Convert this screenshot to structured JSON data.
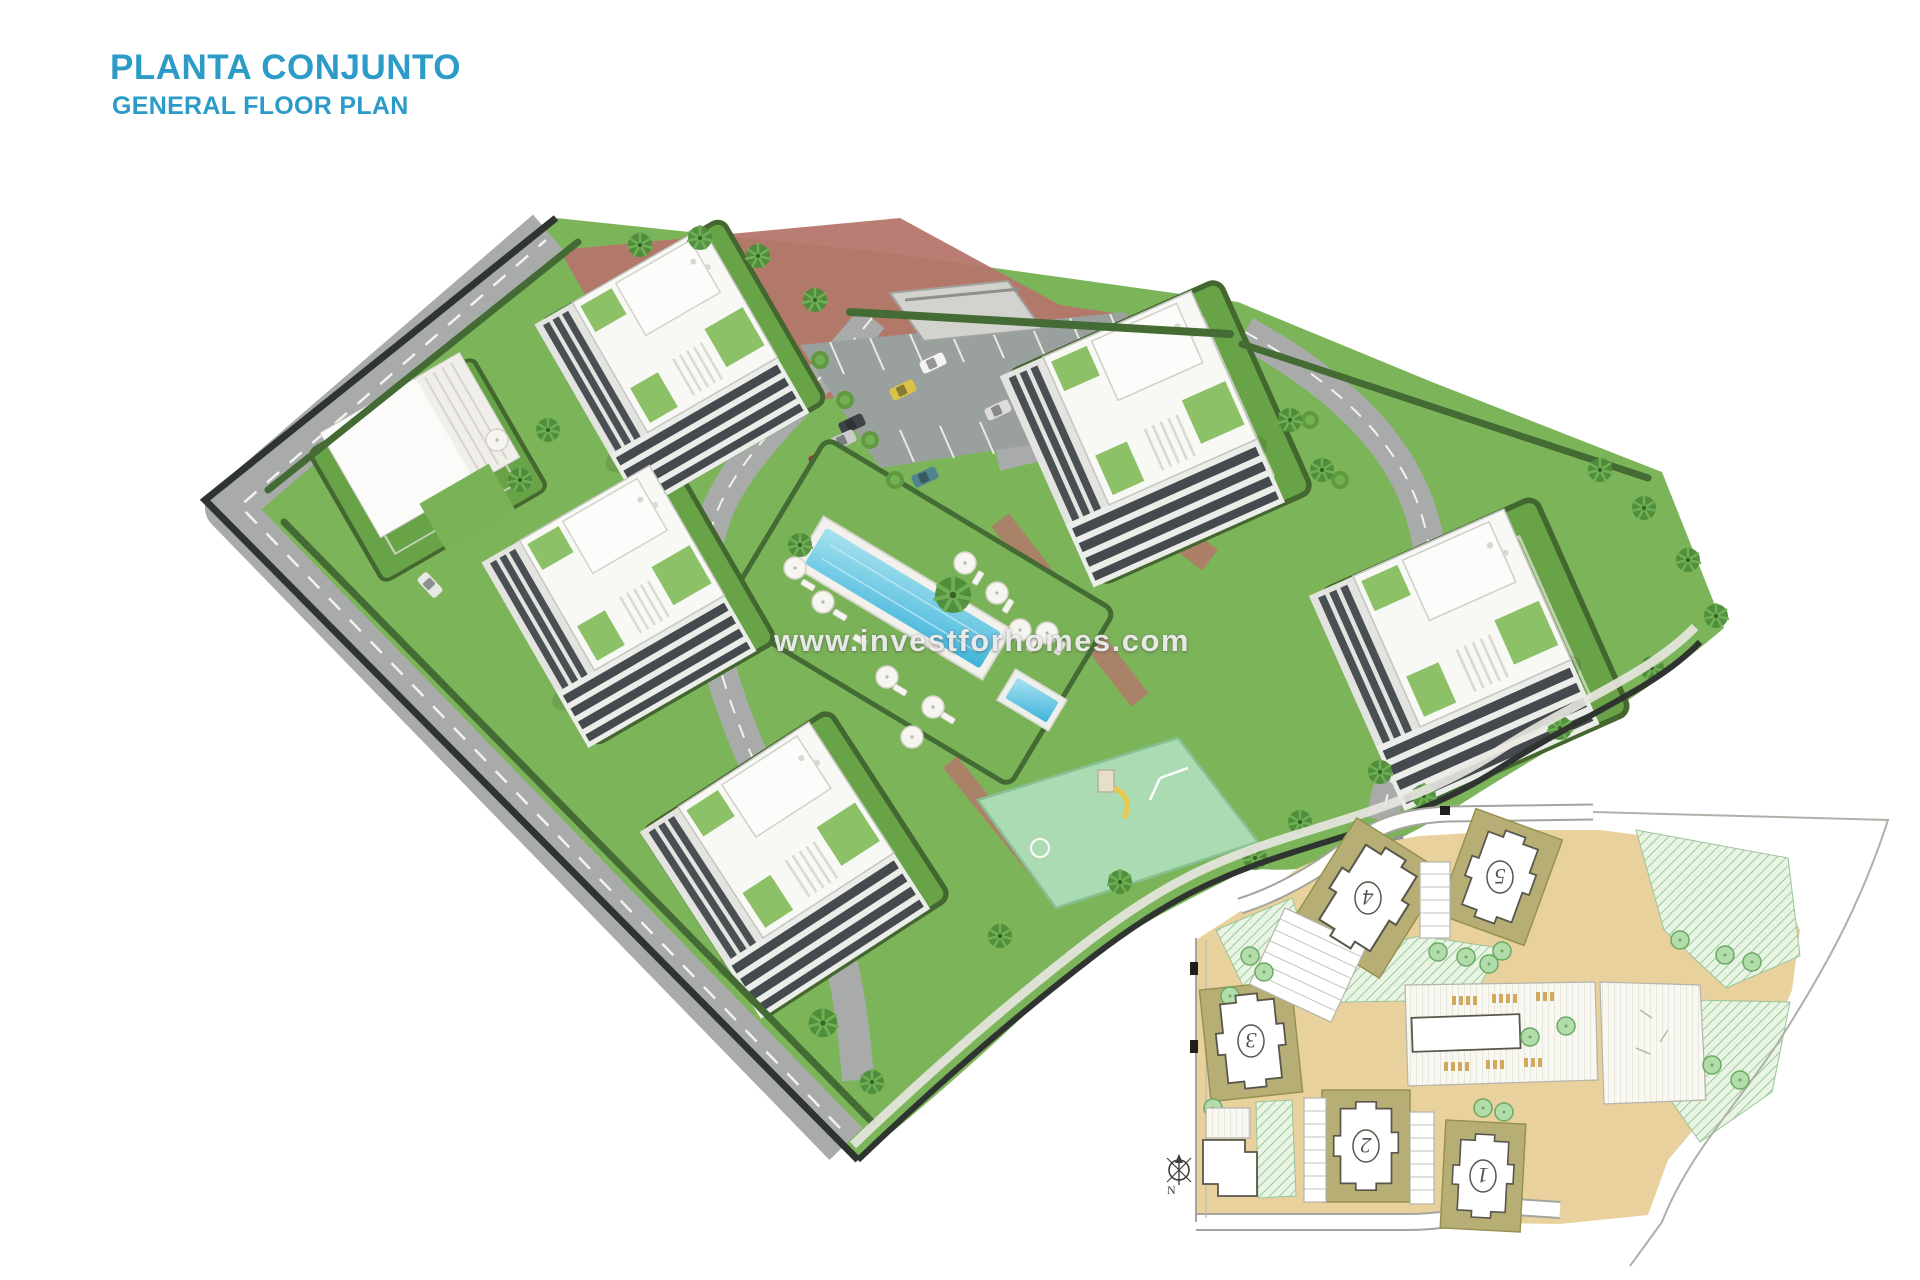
{
  "header": {
    "title": "PLANTA CONJUNTO",
    "subtitle": "GENERAL FLOOR PLAN",
    "title_color": "#2D9BC8"
  },
  "watermark": {
    "text": "www.investforhomes.com"
  },
  "colors": {
    "accent_blue": "#2D9BC8",
    "grass_green": "#7cb45a",
    "road_gray": "#a8abaa",
    "pool_blue": "#3fb4da",
    "brick_path": "#b5766c",
    "playground_green": "#aadbb2",
    "boundary_wall": "#2f3431",
    "inset_beige": "#e9d19e",
    "inset_olive_pad": "#b6ae74",
    "inset_hatch_green": "#97cd97"
  },
  "inset_plan": {
    "buildings": [
      {
        "label": "1"
      },
      {
        "label": "2"
      },
      {
        "label": "3"
      },
      {
        "label": "4"
      },
      {
        "label": "5"
      }
    ],
    "compass": "N"
  }
}
